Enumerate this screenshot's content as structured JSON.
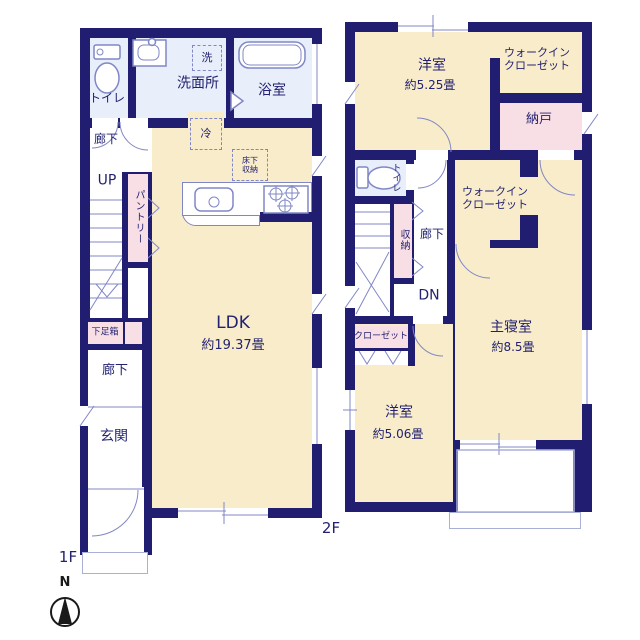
{
  "colors": {
    "wall": "#211d70",
    "cream": "#f8ecca",
    "wet": "#e8eefa",
    "pink": "#f8dfe6",
    "line": "#8087c6",
    "text": "#232270"
  },
  "floor1": {
    "floor_label": "1F",
    "toilet": "トイレ",
    "washer": "洗",
    "washroom": "洗面所",
    "bathroom": "浴室",
    "fridge": "冷",
    "underfloor_storage_line1": "床下",
    "underfloor_storage_line2": "収納",
    "hallway_upper": "廊下",
    "stairs_up": "UP",
    "pantry": "パントリー",
    "ldk_name": "LDK",
    "ldk_size": "約19.37畳",
    "shoe_cabinet": "下足箱",
    "hallway_lower": "廊下",
    "entrance": "玄関"
  },
  "floor2": {
    "floor_label": "2F",
    "bedroom_a_name": "洋室",
    "bedroom_a_size": "約5.25畳",
    "wic_a_line1": "ウォークイン",
    "wic_a_line2": "クローゼット",
    "storeroom": "納戸",
    "toilet": "トイレ",
    "storage": "収納",
    "hallway": "廊下",
    "stairs_down": "DN",
    "wic_b_line1": "ウォークイン",
    "wic_b_line2": "クローゼット",
    "master_name": "主寝室",
    "master_size": "約8.5畳",
    "closet": "クローゼット",
    "bedroom_b_name": "洋室",
    "bedroom_b_size": "約5.06畳"
  },
  "compass": {
    "north_label": "N"
  }
}
